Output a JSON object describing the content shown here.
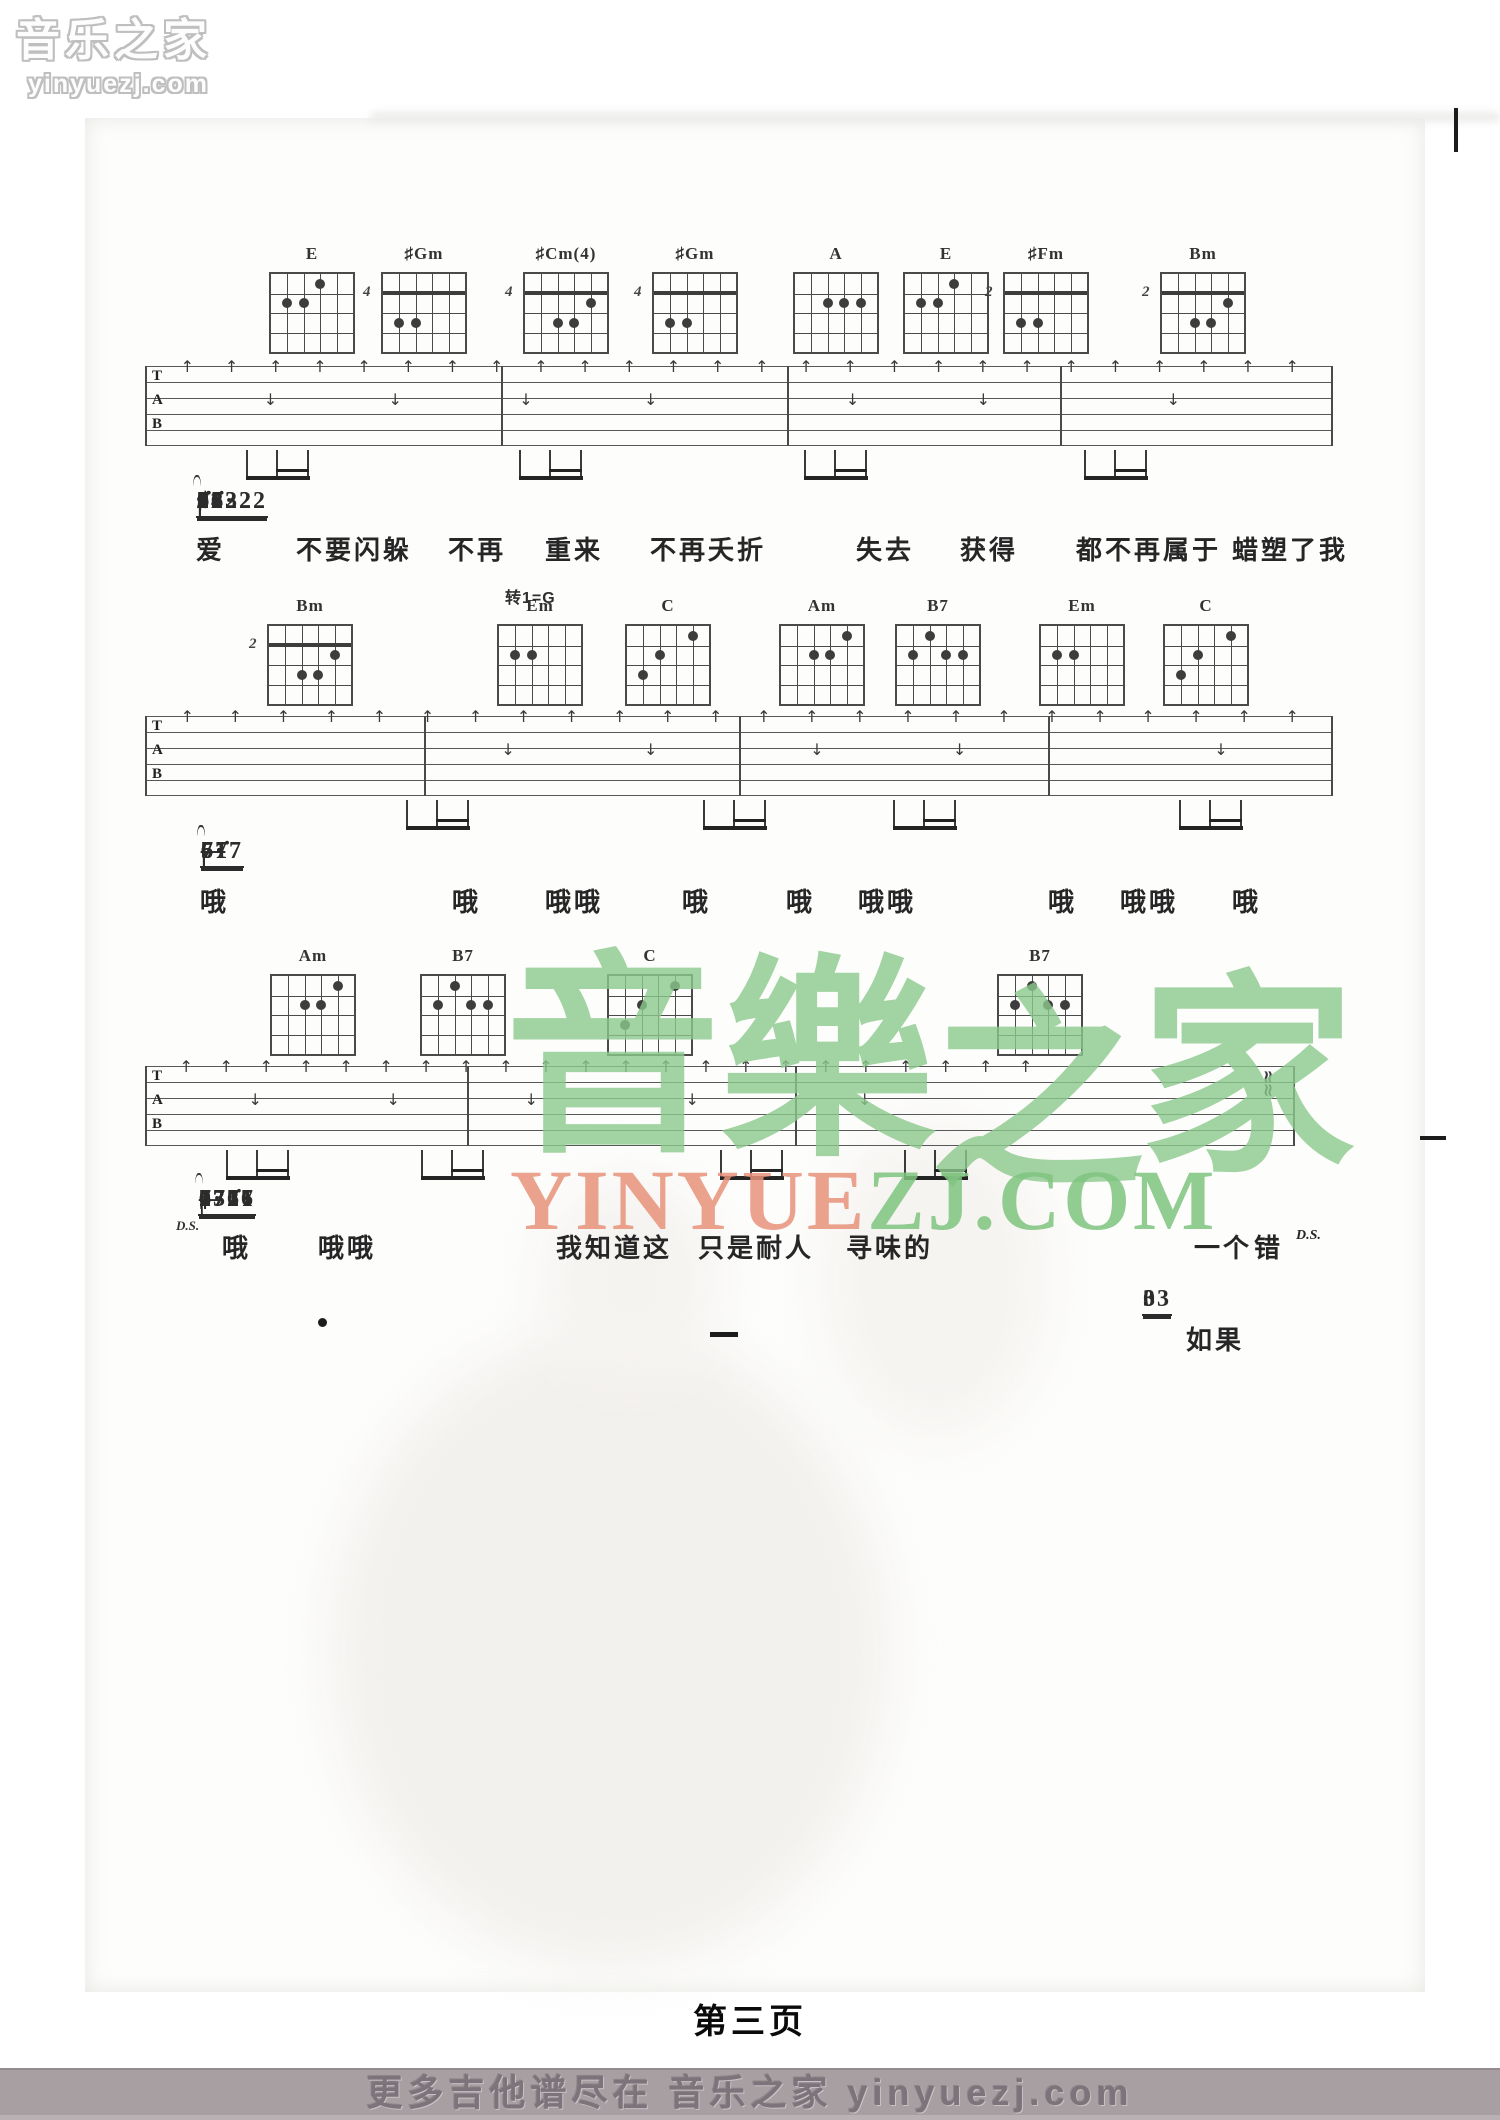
{
  "page": {
    "number_label": "第三页"
  },
  "logo": {
    "title": "音乐之家",
    "domain": "yinyuezj.com"
  },
  "watermark": {
    "chars": [
      "音",
      "樂",
      "之",
      "家"
    ],
    "site_left": "YINYUE",
    "site_right": "ZJ.COM"
  },
  "footer": {
    "text": "更多吉他谱尽在 音乐之家 yinyuezj.com"
  },
  "colors": {
    "watermark_green": "#8cc98c",
    "watermark_salmon": "#e8937b",
    "footer_bar": "#a79fa1",
    "ink": "#3a3a3a"
  },
  "systems": [
    {
      "chord_y": 272,
      "chords": [
        {
          "label": "E",
          "x": 312,
          "dots": [
            [
              1,
              2
            ],
            [
              2,
              2
            ],
            [
              3,
              1
            ]
          ]
        },
        {
          "label": "♯Gm",
          "x": 424,
          "pos": "4",
          "barre": true,
          "dots": [
            [
              1,
              3
            ],
            [
              2,
              3
            ]
          ]
        },
        {
          "label": "♯Cm(4)",
          "x": 566,
          "pos": "4",
          "barre": true,
          "dots": [
            [
              2,
              3
            ],
            [
              3,
              3
            ],
            [
              4,
              2
            ]
          ]
        },
        {
          "label": "♯Gm",
          "x": 695,
          "pos": "4",
          "barre": true,
          "dots": [
            [
              1,
              3
            ],
            [
              2,
              3
            ]
          ]
        },
        {
          "label": "A",
          "x": 836,
          "dots": [
            [
              2,
              2
            ],
            [
              3,
              2
            ],
            [
              4,
              2
            ]
          ]
        },
        {
          "label": "E",
          "x": 946,
          "dots": [
            [
              1,
              2
            ],
            [
              2,
              2
            ],
            [
              3,
              1
            ]
          ]
        },
        {
          "label": "♯Fm",
          "x": 1046,
          "pos": "2",
          "barre": true,
          "dots": [
            [
              1,
              3
            ],
            [
              2,
              3
            ]
          ]
        },
        {
          "label": "Bm",
          "x": 1203,
          "pos": "2",
          "barre": true,
          "dots": [
            [
              2,
              3
            ],
            [
              3,
              3
            ],
            [
              4,
              2
            ]
          ]
        }
      ],
      "staff": {
        "x": 145,
        "y": 366,
        "w": 1188,
        "bars": [
          0,
          0.3,
          0.54,
          0.77,
          0.999
        ],
        "arrows": 26,
        "downs": [
          0.1,
          0.205,
          0.315,
          0.42,
          0.59,
          0.7,
          0.86
        ],
        "beams": [
          0.085,
          0.315,
          0.555,
          0.79
        ]
      },
      "notation": {
        "x": 196,
        "y": 488,
        "gap": 18,
        "tokens": [
          {
            "t": "♯3",
            "tie": 1
          },
          {
            "t": "32",
            "u": 1
          },
          {
            "t": "1",
            "u": 1
          },
          {
            "t": "2",
            "u": 1
          },
          {
            "t": "3·",
            "u": 1
          },
          {
            "t": "02",
            "u": 1
          },
          {
            "t": "1",
            "u": 1
          },
          {
            "t": "|",
            "bar": 1
          },
          {
            "t": "2"
          },
          {
            "t": "3·",
            "u": 1
          },
          {
            "t": "02",
            "u": 1
          },
          {
            "t": "1",
            "u": 1
          },
          {
            "t": "2",
            "u": 1
          },
          {
            "t": "7·",
            "u": 1,
            "tie": 1
          },
          {
            "t": "7"
          },
          {
            "t": "|",
            "bar": 1
          },
          {
            "t": "06",
            "u": 1
          },
          {
            "t": "1̇1̇",
            "u": 1
          },
          {
            "t": "♯3",
            "tie": 1
          },
          {
            "t": "1̇1̇",
            "u": 1
          },
          {
            "t": "|",
            "bar": 1
          },
          {
            "t": "0222",
            "u": 2
          },
          {
            "t": "1̇6·",
            "u": 1
          },
          {
            "t": "34322",
            "u": 2
          },
          {
            "t": "|",
            "bar": 1
          }
        ]
      },
      "lyrics": {
        "y": 530,
        "items": [
          {
            "x": 196,
            "t": "爱"
          },
          {
            "x": 296,
            "t": "不要闪躲"
          },
          {
            "x": 448,
            "t": "不再"
          },
          {
            "x": 545,
            "t": "重来"
          },
          {
            "x": 650,
            "t": "不再夭折"
          },
          {
            "x": 856,
            "t": "失去"
          },
          {
            "x": 960,
            "t": "获得"
          },
          {
            "x": 1076,
            "t": "都不再属于"
          },
          {
            "x": 1232,
            "t": "蜡塑了我"
          }
        ]
      }
    },
    {
      "chord_y": 624,
      "key_change": {
        "x": 505,
        "y": 584,
        "t": "转1=G"
      },
      "chords": [
        {
          "label": "Bm",
          "x": 310,
          "pos": "2",
          "barre": true,
          "dots": [
            [
              2,
              3
            ],
            [
              3,
              3
            ],
            [
              4,
              2
            ]
          ]
        },
        {
          "label": "Em",
          "x": 540,
          "dots": [
            [
              1,
              2
            ],
            [
              2,
              2
            ]
          ]
        },
        {
          "label": "C",
          "x": 668,
          "dots": [
            [
              1,
              3
            ],
            [
              2,
              2
            ],
            [
              4,
              1
            ]
          ]
        },
        {
          "label": "Am",
          "x": 822,
          "dots": [
            [
              2,
              2
            ],
            [
              3,
              2
            ],
            [
              4,
              1
            ]
          ]
        },
        {
          "label": "B7",
          "x": 938,
          "dots": [
            [
              1,
              2
            ],
            [
              2,
              1
            ],
            [
              3,
              2
            ],
            [
              4,
              2
            ]
          ]
        },
        {
          "label": "Em",
          "x": 1082,
          "dots": [
            [
              1,
              2
            ],
            [
              2,
              2
            ]
          ]
        },
        {
          "label": "C",
          "x": 1206,
          "dots": [
            [
              1,
              3
            ],
            [
              2,
              2
            ],
            [
              4,
              1
            ]
          ]
        }
      ],
      "staff": {
        "x": 145,
        "y": 716,
        "w": 1188,
        "bars": [
          0,
          0.235,
          0.5,
          0.76,
          0.999
        ],
        "arrows": 24,
        "downs": [
          0.3,
          0.42,
          0.56,
          0.68,
          0.9
        ],
        "beams": [
          0.22,
          0.47,
          0.63,
          0.87
        ]
      },
      "notation": {
        "x": 200,
        "y": 838,
        "gap": 29,
        "tokens": [
          {
            "t": "5"
          },
          {
            "t": "—"
          },
          {
            "t": "—"
          },
          {
            "t": "—"
          },
          {
            "t": "|",
            "bar": 1
          },
          {
            "t": "6·"
          },
          {
            "t": "71̇",
            "u": 2,
            "tie": 1
          },
          {
            "t": "6·"
          },
          {
            "t": "71̇",
            "u": 2,
            "tie": 1
          },
          {
            "t": "|",
            "bar": 1
          },
          {
            "t": "6·"
          },
          {
            "t": "677",
            "u": 2,
            "tie": 1
          },
          {
            "t": "—"
          },
          {
            "t": "|",
            "bar": 1
          },
          {
            "t": "6·"
          },
          {
            "t": "71̇",
            "u": 2,
            "tie": 1
          },
          {
            "t": "6·"
          },
          {
            "t": "71̇",
            "u": 2,
            "tie": 1
          },
          {
            "t": "|",
            "bar": 1
          }
        ]
      },
      "lyrics": {
        "y": 882,
        "items": [
          {
            "x": 200,
            "t": "哦"
          },
          {
            "x": 452,
            "t": "哦"
          },
          {
            "x": 545,
            "t": "哦哦"
          },
          {
            "x": 682,
            "t": "哦"
          },
          {
            "x": 786,
            "t": "哦"
          },
          {
            "x": 858,
            "t": "哦哦"
          },
          {
            "x": 1048,
            "t": "哦"
          },
          {
            "x": 1120,
            "t": "哦哦"
          },
          {
            "x": 1232,
            "t": "哦"
          }
        ]
      }
    },
    {
      "chord_y": 974,
      "chords": [
        {
          "label": "Am",
          "x": 313,
          "dots": [
            [
              2,
              2
            ],
            [
              3,
              2
            ],
            [
              4,
              1
            ]
          ]
        },
        {
          "label": "B7",
          "x": 463,
          "dots": [
            [
              1,
              2
            ],
            [
              2,
              1
            ],
            [
              3,
              2
            ],
            [
              4,
              2
            ]
          ]
        },
        {
          "label": "C",
          "x": 650,
          "dots": [
            [
              1,
              3
            ],
            [
              2,
              2
            ],
            [
              4,
              1
            ]
          ]
        },
        {
          "label": "B7",
          "x": 1040,
          "dots": [
            [
              1,
              2
            ],
            [
              2,
              1
            ],
            [
              3,
              2
            ],
            [
              4,
              2
            ]
          ]
        }
      ],
      "staff": {
        "x": 145,
        "y": 1066,
        "w": 1150,
        "bars": [
          0,
          0.28,
          0.565,
          0.999
        ],
        "arrows": 22,
        "span": [
          0.03,
          0.76
        ],
        "downs": [
          0.09,
          0.21,
          0.33,
          0.47,
          0.62
        ],
        "beams": [
          0.07,
          0.24,
          0.5,
          0.66
        ],
        "squiggle": 0.965
      },
      "notation": {
        "x": 198,
        "y": 1186,
        "gap": 44,
        "tokens": [
          {
            "t": "6·"
          },
          {
            "t": "677",
            "u": 2
          },
          {
            "t": "—"
          },
          {
            "t": "‖",
            "bar": 1,
            "ds": "D.S."
          },
          {
            "t": "0321",
            "u": 2
          },
          {
            "t": "2",
            "u": 1
          },
          {
            "t": "171̇7",
            "u": 2
          },
          {
            "t": "677·",
            "u": 1,
            "tie": 1
          },
          {
            "t": "|",
            "bar": 1
          },
          {
            "t": "7"
          },
          {
            "t": "—"
          },
          {
            "t": "0"
          },
          {
            "t": "7766",
            "u": 2,
            "tie": 1
          },
          {
            "t": "‖",
            "bar": 1
          }
        ]
      },
      "lyrics": {
        "y": 1228,
        "items": [
          {
            "x": 222,
            "t": "哦"
          },
          {
            "x": 318,
            "t": "哦哦"
          },
          {
            "x": 556,
            "t": "我知道这"
          },
          {
            "x": 698,
            "t": "只是耐人"
          },
          {
            "x": 846,
            "t": "寻味的"
          },
          {
            "x": 1194,
            "t": "一个"
          },
          {
            "x": 1254,
            "t": "错"
          },
          {
            "x": 1296,
            "t": "D.S.",
            "small": 1
          }
        ]
      }
    },
    {
      "chord_y": 0,
      "chords": [],
      "staff": null,
      "notation": {
        "x": 1142,
        "y": 1286,
        "gap": 30,
        "tokens": [
          {
            "t": "0",
            "u": 1
          },
          {
            "t": "33",
            "u": 2
          }
        ]
      },
      "lyrics": {
        "y": 1320,
        "items": [
          {
            "x": 1186,
            "t": "如果"
          }
        ]
      }
    }
  ],
  "marks": [
    {
      "x": 1454,
      "y": 108,
      "w": 4,
      "h": 44
    },
    {
      "x": 318,
      "y": 1318,
      "w": 9,
      "h": 9,
      "dot": 1
    },
    {
      "x": 710,
      "y": 1332,
      "w": 28,
      "h": 5
    },
    {
      "x": 1420,
      "y": 1136,
      "w": 26,
      "h": 4
    }
  ]
}
